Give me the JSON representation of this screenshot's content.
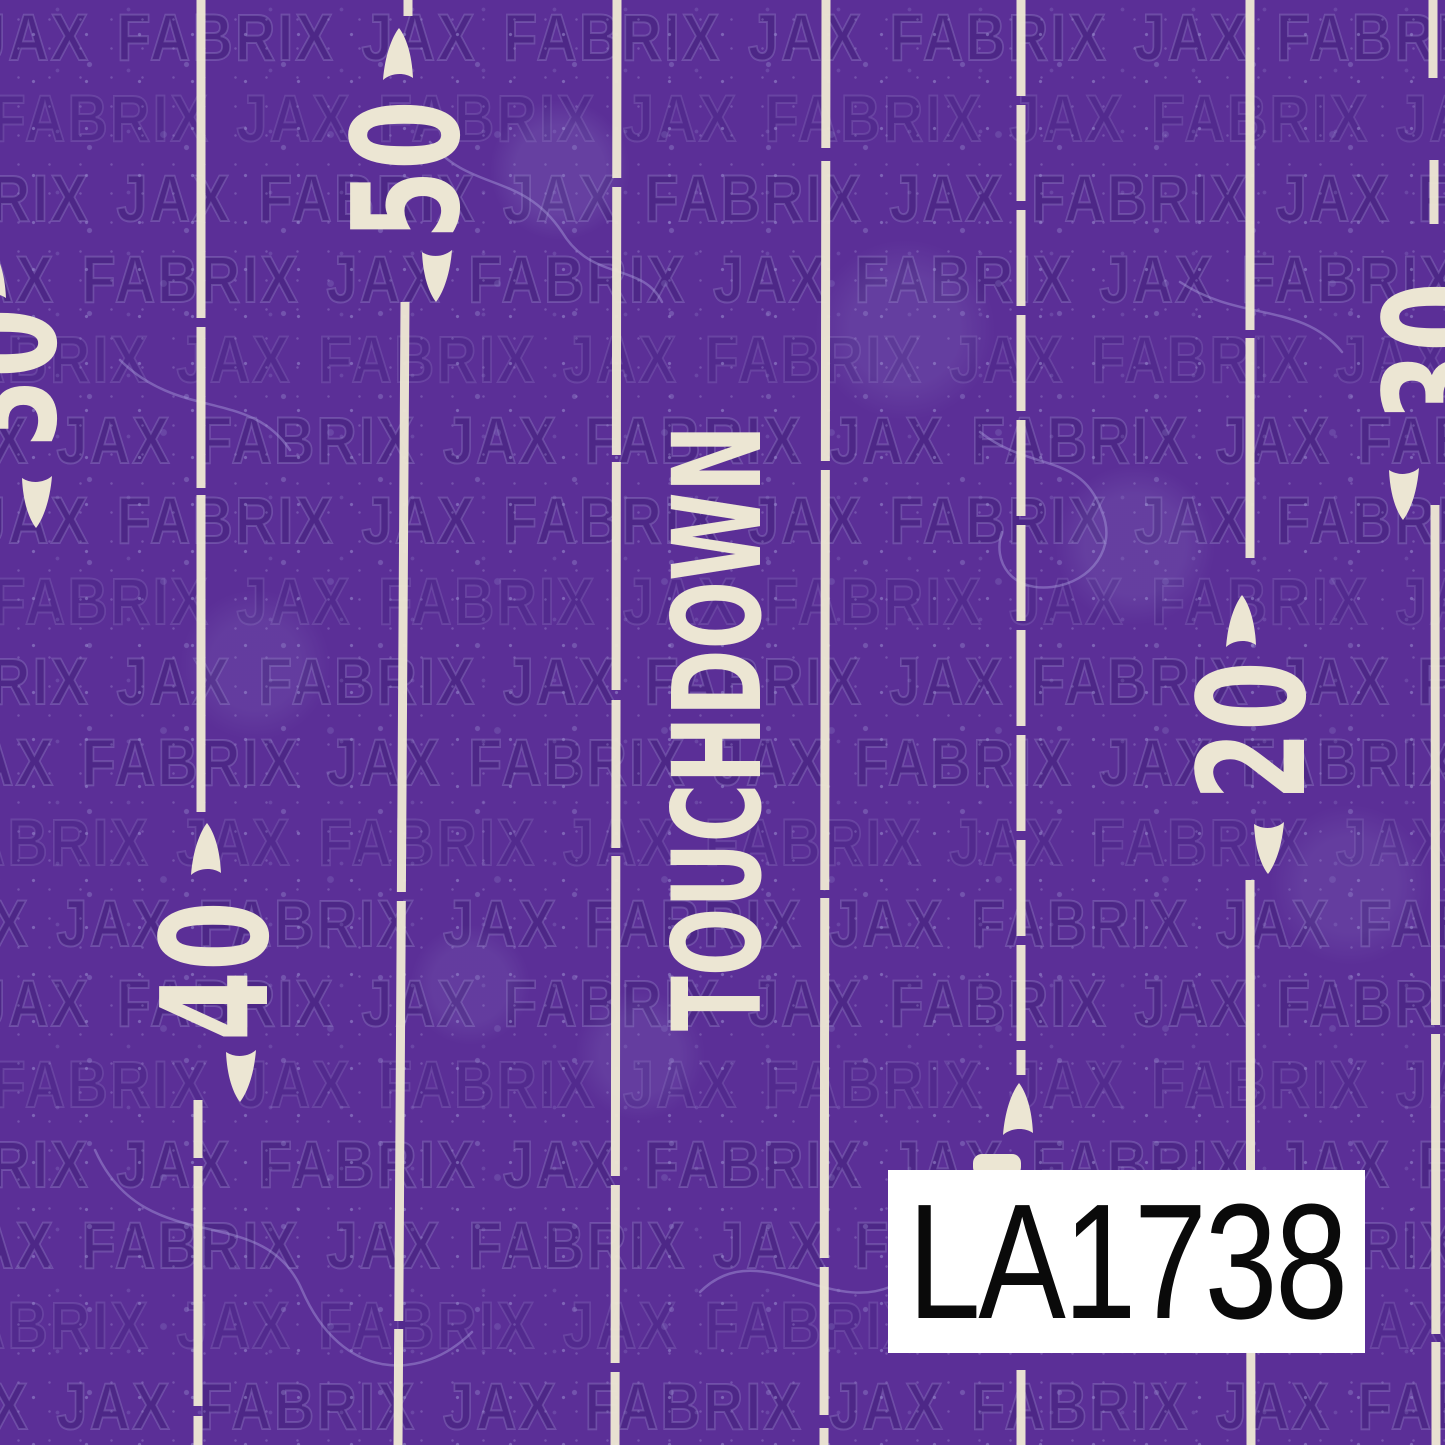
{
  "product_label": {
    "code": "LA1738"
  },
  "watermark": {
    "brand_text": "JAX FABRIX"
  },
  "field_markings": {
    "touchdown_text": "TOUCHDOWN",
    "yard_numbers": {
      "fifty": "50",
      "forty": "40",
      "thirty": "30",
      "twenty": "20"
    }
  },
  "colors": {
    "background_purple": "#5b2f97",
    "marking_cream": "#ece6d3",
    "speckle_light_purple": "#8b7ec4",
    "watermark_outline": "#b6acde",
    "label_background": "#ffffff",
    "label_text": "#0a0a0a"
  }
}
